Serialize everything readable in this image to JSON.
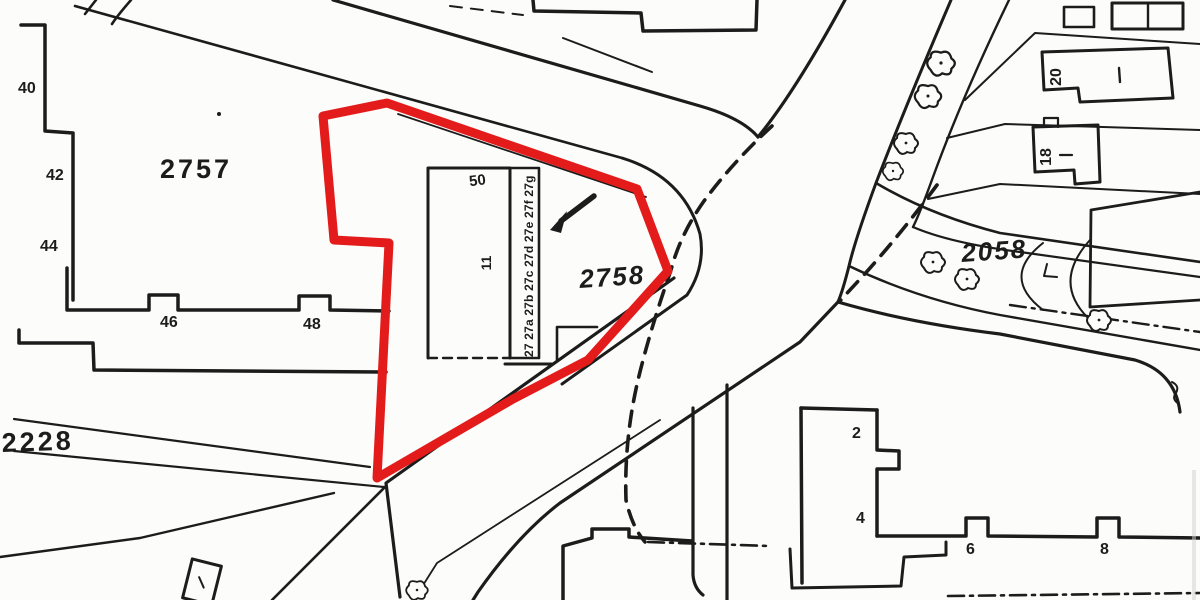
{
  "map": {
    "parcels": {
      "left": "2757",
      "center": "2758",
      "right": "2058",
      "path": "2228"
    },
    "plot": {
      "number": "50",
      "building_mark": "11",
      "terrace_units": "27 27a 27b 27c 27d 27e 27f 27g"
    },
    "houses": {
      "h40": "40",
      "h42": "42",
      "h44": "44",
      "h46": "46",
      "h48": "48",
      "h20": "20",
      "h18": "18",
      "h2": "2",
      "h4": "4",
      "h6": "6",
      "h8": "8"
    },
    "icons": {
      "tree": "tree-symbol",
      "arrow": "arrow-pointer",
      "dashes": "boundary-dashed-line"
    },
    "colors": {
      "boundary": "#e31b1b",
      "ink": "#1c1c1c",
      "paper": "#fcfcfa"
    }
  }
}
